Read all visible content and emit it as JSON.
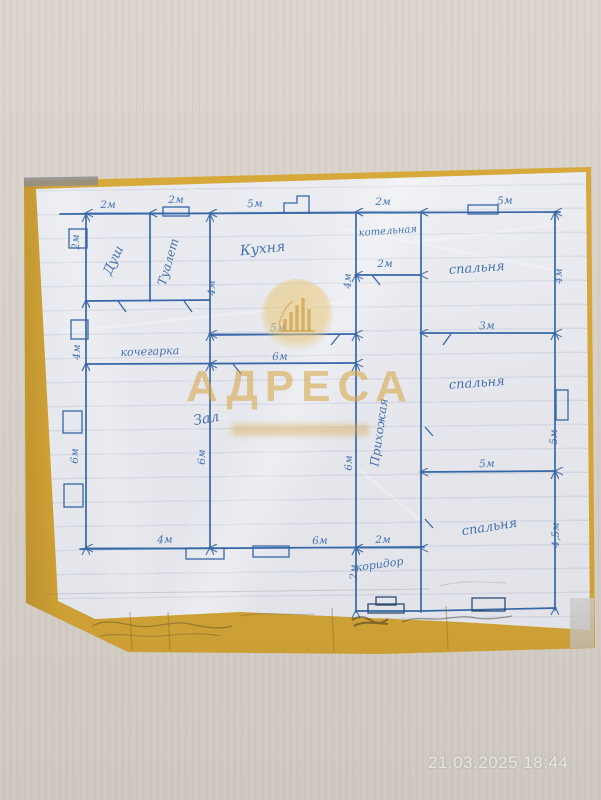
{
  "meta": {
    "timestamp": "21.03.2025 18:44"
  },
  "watermark": {
    "brand": "АДРЕСА",
    "logo": "building-bars-icon",
    "color": "#d8a746"
  },
  "floor_plan": {
    "ink_color": "#3767a6",
    "rooms": [
      {
        "id": "dush",
        "label": "Душ",
        "x": 117,
        "y": 262,
        "rot": -65,
        "size": 13
      },
      {
        "id": "tualet",
        "label": "Туалет",
        "x": 172,
        "y": 263,
        "rot": -74,
        "size": 12
      },
      {
        "id": "kuhnya",
        "label": "Кухня",
        "x": 263,
        "y": 253,
        "rot": -6,
        "size": 14
      },
      {
        "id": "kotelnaya",
        "label": "котельная",
        "x": 388,
        "y": 234,
        "rot": -4,
        "size": 10
      },
      {
        "id": "spalnya-1",
        "label": "спальня",
        "x": 477,
        "y": 272,
        "rot": -4,
        "size": 13
      },
      {
        "id": "spalnya-2",
        "label": "спальня",
        "x": 477,
        "y": 387,
        "rot": -4,
        "size": 13
      },
      {
        "id": "spalnya-3",
        "label": "спальня",
        "x": 490,
        "y": 531,
        "rot": -9,
        "size": 13
      },
      {
        "id": "prihozhaya",
        "label": "Прихожая",
        "x": 383,
        "y": 433,
        "rot": -82,
        "size": 12
      },
      {
        "id": "zal",
        "label": "Зал",
        "x": 207,
        "y": 423,
        "rot": -10,
        "size": 14
      },
      {
        "id": "kochegarka",
        "label": "кочегарка",
        "x": 150,
        "y": 355,
        "rot": -2,
        "size": 11
      },
      {
        "id": "koridor",
        "label": "коридор",
        "x": 380,
        "y": 568,
        "rot": -8,
        "size": 11
      }
    ],
    "dimensions": [
      {
        "label": "2м",
        "x": 108,
        "y": 208,
        "rot": 0
      },
      {
        "label": "2м",
        "x": 176,
        "y": 203,
        "rot": 0
      },
      {
        "label": "5м",
        "x": 255,
        "y": 207,
        "rot": -2
      },
      {
        "label": "2м",
        "x": 383,
        "y": 205,
        "rot": 0
      },
      {
        "label": "5м",
        "x": 505,
        "y": 204,
        "rot": -2
      },
      {
        "label": "2м",
        "x": 79,
        "y": 242,
        "rot": -90
      },
      {
        "label": "4м",
        "x": 80,
        "y": 352,
        "rot": -90
      },
      {
        "label": "6м",
        "x": 78,
        "y": 456,
        "rot": -90
      },
      {
        "label": "4м",
        "x": 562,
        "y": 276,
        "rot": -90
      },
      {
        "label": "5м",
        "x": 557,
        "y": 437,
        "rot": -90
      },
      {
        "label": "4,5м",
        "x": 559,
        "y": 535,
        "rot": -90
      },
      {
        "label": "4м",
        "x": 215,
        "y": 288,
        "rot": -90
      },
      {
        "label": "4м",
        "x": 351,
        "y": 281,
        "rot": -90
      },
      {
        "label": "6м",
        "x": 205,
        "y": 457,
        "rot": -90
      },
      {
        "label": "6м",
        "x": 352,
        "y": 463,
        "rot": -90
      },
      {
        "label": "2м",
        "x": 357,
        "y": 572,
        "rot": -90
      },
      {
        "label": "2м",
        "x": 385,
        "y": 267,
        "rot": 0
      },
      {
        "label": "5м",
        "x": 278,
        "y": 331,
        "rot": -2
      },
      {
        "label": "6м",
        "x": 280,
        "y": 360,
        "rot": -2
      },
      {
        "label": "3м",
        "x": 487,
        "y": 329,
        "rot": -2
      },
      {
        "label": "5м",
        "x": 487,
        "y": 467,
        "rot": -2
      },
      {
        "label": "4м",
        "x": 165,
        "y": 543,
        "rot": -2
      },
      {
        "label": "6м",
        "x": 320,
        "y": 544,
        "rot": -2
      },
      {
        "label": "2м",
        "x": 383,
        "y": 543,
        "rot": 0
      }
    ]
  }
}
